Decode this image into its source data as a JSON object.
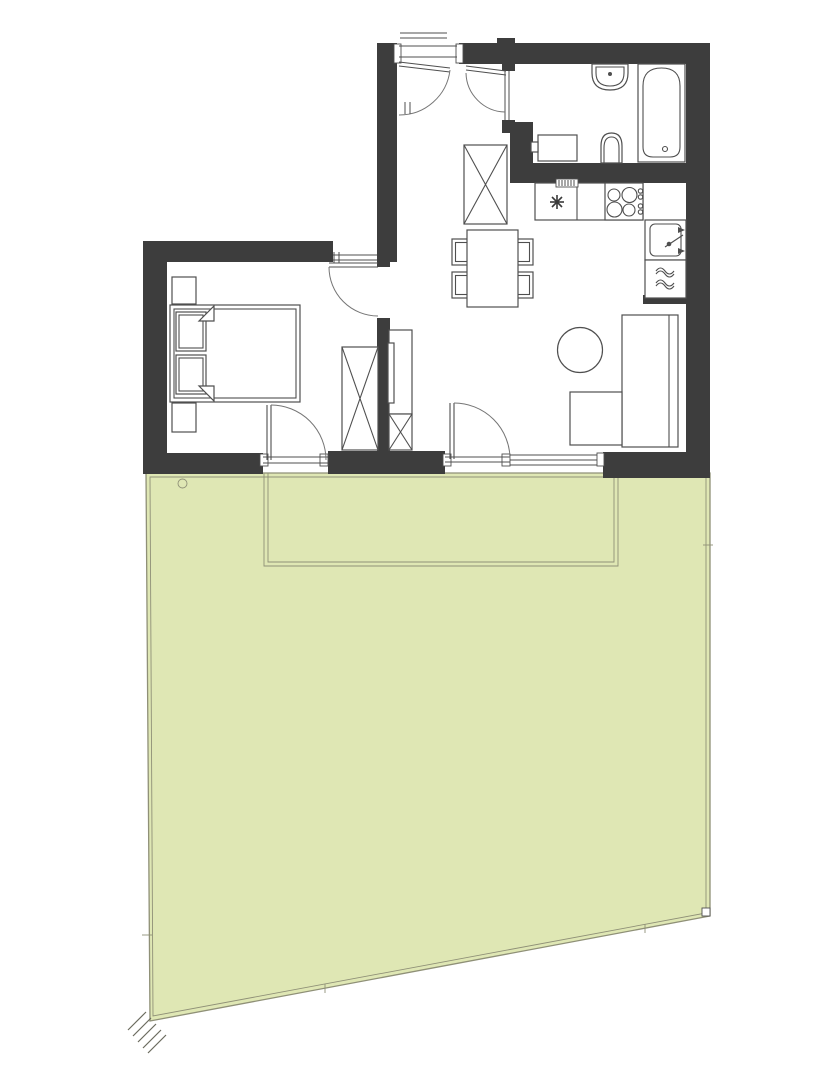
{
  "meta": {
    "kind": "architectural-floor-plan",
    "canvas_width": 818,
    "canvas_height": 1080,
    "labels_visible": "none"
  },
  "colors": {
    "wall": "#3d3d3d",
    "line": "#4f4f4f",
    "arc": "#757575",
    "garden_fill": "#dfe7b4",
    "fence_line": "#8f9077",
    "background": "#ffffff"
  },
  "plan": {
    "rooms": [
      {
        "name": "hallway",
        "features": [
          "entry-door",
          "wardrobe",
          "bathroom-door"
        ]
      },
      {
        "name": "bathroom",
        "features": [
          "washbasin",
          "bathtub",
          "toilet",
          "washing-machine"
        ]
      },
      {
        "name": "kitchen",
        "features": [
          "counter",
          "vent-grille",
          "star-symbol",
          "cooktop-4-burners",
          "sink-with-faucet",
          "dishwasher-waves"
        ]
      },
      {
        "name": "living-dining",
        "features": [
          "dining-table",
          "chairs-x4",
          "round-coffee-table",
          "l-shaped-sofa",
          "tv-cabinet",
          "terrace-door",
          "window"
        ]
      },
      {
        "name": "bedroom",
        "features": [
          "double-bed",
          "pillows-x2",
          "nightstands-x2",
          "wardrobe",
          "terrace-door"
        ]
      },
      {
        "name": "garden",
        "features": [
          "terrace-outline",
          "drain-circle",
          "fence-boundary",
          "corner-hatch-marks",
          "fence-ticks"
        ]
      }
    ],
    "counts": {
      "doors_with_swing_arcs": 5,
      "wardrobes": 3,
      "chairs": 4,
      "burners": 4
    }
  }
}
